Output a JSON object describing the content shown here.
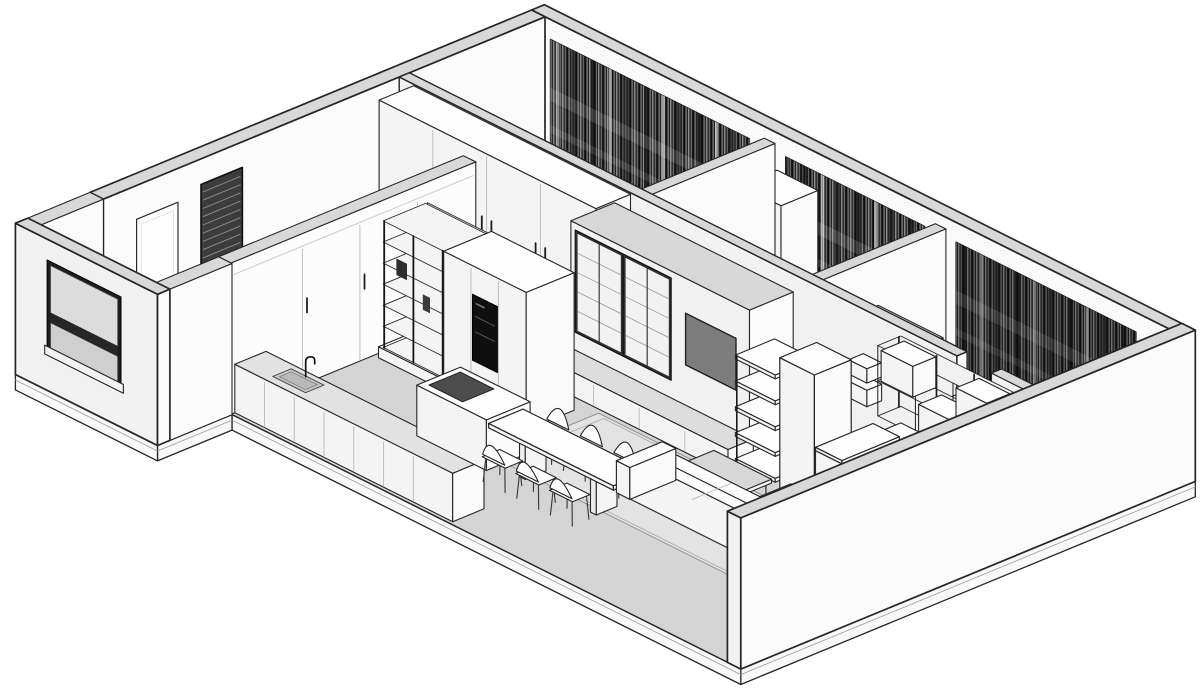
{
  "view": "axonometric-apartment-cutaway",
  "colors": {
    "background": "#ffffff",
    "outline": "#262626",
    "wall_top": "#d8d8d8",
    "wall_sw": "#f1f1f1",
    "wall_se": "#fbfbfb",
    "floor": "#d4d4d4",
    "floor_bedroom": "#ededed",
    "slab": "#f8f8f8",
    "rug": "#e3e3e3",
    "furn_top": "#fdfdfd",
    "furn_sw": "#f4f4f4",
    "furn_se": "#fafafa",
    "tv": "#7d7d7d",
    "cooktop": "#4d4d4d",
    "appliance": "#0f0f0f",
    "curtain": "#454545",
    "glass": "#dcdcdc",
    "metal": "#111111"
  },
  "projection": {
    "origin": [
      545,
      168
    ],
    "ux": [
      48,
      24
    ],
    "vy": [
      -46,
      19
    ],
    "zh": 55
  },
  "scene": {
    "elements": [
      {
        "t": "floor",
        "n": "floor-slab",
        "pts": [
          [
            -0.28,
            -0.28
          ],
          [
            13.28,
            -0.28
          ],
          [
            13.28,
            9.6
          ],
          [
            2.68,
            9.6
          ],
          [
            2.68,
            11.22
          ],
          [
            -0.28,
            11.22
          ]
        ],
        "edgeFrom": 1
      },
      {
        "t": "flat",
        "n": "bedroom-floor",
        "pts": [
          [
            0.1,
            0.1
          ],
          [
            12.9,
            0.1
          ],
          [
            12.9,
            2.95
          ],
          [
            0.1,
            2.95
          ]
        ],
        "fill": "#ededed"
      },
      {
        "t": "box",
        "n": "wall-ne",
        "x": -0.28,
        "y": -0.28,
        "dx": 13.56,
        "dy": 0.28,
        "dz": 2.75,
        "wall": true,
        "faces": [
          "top",
          "sw"
        ],
        "fsw": "#fafafa",
        "lw": 1.7
      },
      {
        "t": "box",
        "n": "wall-nw",
        "x": -0.28,
        "y": 0,
        "dx": 0.28,
        "dy": 9.6,
        "dz": 2.75,
        "wall": true,
        "faces": [
          "top",
          "se"
        ],
        "lw": 1.7
      },
      {
        "t": "blinds",
        "n": "entry-blinds-door",
        "x": 0.02,
        "y1": 6.6,
        "y2": 7.5,
        "z1": 0.06,
        "z2": 2.3
      },
      {
        "t": "doorX",
        "n": "hall-door",
        "x": 0.02,
        "y1": 8.0,
        "y2": 8.9,
        "z1": 0,
        "z2": 2.15
      },
      {
        "t": "curtain",
        "n": "curtains-bedroom-a",
        "x1": 0.4,
        "x2": 4.55,
        "dark": false
      },
      {
        "t": "curtain",
        "n": "curtains-bedroom-b",
        "x1": 5.3,
        "x2": 8.2,
        "dark": false
      },
      {
        "t": "curtain",
        "n": "curtains-bedroom-c",
        "x1": 8.85,
        "x2": 12.6,
        "dark": true
      },
      {
        "t": "box",
        "n": "bedroom-b-closet",
        "x": 5.12,
        "y": 0.3,
        "dx": 0.85,
        "dy": 0.8,
        "dz": 2.3,
        "seamsX": [
          5.55
        ]
      },
      {
        "t": "box",
        "n": "partition-a-b",
        "x": 4.84,
        "y": 0.28,
        "dx": 0.22,
        "dy": 2.67,
        "dz": 2.75,
        "wall": true
      },
      {
        "t": "box",
        "n": "partition-b-c",
        "x": 8.4,
        "y": 0.28,
        "dx": 0.22,
        "dy": 2.67,
        "dz": 2.75,
        "wall": true
      },
      {
        "t": "box",
        "n": "bedroom-c-closet",
        "x": 9.1,
        "y": 2.25,
        "dx": 1.35,
        "dy": 0.7,
        "dz": 2.25,
        "seamsX": [
          9.55,
          10.0
        ]
      },
      {
        "t": "box",
        "n": "wall-bedrooms-south-left",
        "x": 0,
        "y": 2.95,
        "dx": 11.62,
        "dy": 0.22,
        "dz": 2.75,
        "wall": true,
        "lw": 1.4
      },
      {
        "t": "box",
        "n": "wall-bedrooms-south-right",
        "x": 12.34,
        "y": 2.95,
        "dx": 0.66,
        "dy": 0.22,
        "dz": 2.75,
        "wall": true
      },
      {
        "t": "doorX",
        "n": "bedroom-c-door",
        "x": 11.66,
        "y1": 3.17,
        "y2": 3.95,
        "z1": 0,
        "z2": 2.08
      },
      {
        "t": "box",
        "n": "wall-cube-shelf-a",
        "x": 9.55,
        "y": 3.17,
        "z": 1.25,
        "dx": 0.5,
        "dy": 0.32,
        "dz": 0.3
      },
      {
        "t": "box",
        "n": "wall-cube-shelf-b",
        "x": 9.67,
        "y": 3.17,
        "z": 1.68,
        "dx": 0.38,
        "dy": 0.32,
        "dz": 0.26
      },
      {
        "t": "box",
        "n": "corridor-wardrobe",
        "x": 0.3,
        "y": 3.17,
        "dx": 4.52,
        "dy": 0.75,
        "dz": 2.72,
        "seamsX": [
          1.42,
          2.54,
          3.66
        ],
        "handles": true
      },
      {
        "t": "box",
        "n": "bathroom-block",
        "x": 4.9,
        "y": 3.6,
        "dx": 3.72,
        "dy": 0.95,
        "dz": 2.75,
        "wall": true
      },
      {
        "t": "glass",
        "n": "display-cabinet-left",
        "y": 4.56,
        "x1": 5.05,
        "x2": 5.95,
        "z1": 0.82,
        "z2": 2.58
      },
      {
        "t": "glass",
        "n": "display-cabinet-right",
        "y": 4.56,
        "x1": 6.05,
        "x2": 6.95,
        "z1": 0.82,
        "z2": 2.58
      },
      {
        "t": "tv",
        "n": "tv-screen",
        "y": 4.56,
        "x1": 7.3,
        "x2": 8.35,
        "z1": 1.18,
        "z2": 2.12
      },
      {
        "t": "box",
        "n": "media-console",
        "x": 4.95,
        "y": 4.55,
        "dx": 3.75,
        "dy": 0.55,
        "dz": 0.44,
        "ftop": "#dcdcdc",
        "seamsX": [
          5.9,
          6.85,
          7.8
        ]
      },
      {
        "t": "tower",
        "n": "tall-open-bookcase",
        "col": [
          9.78,
          4.3,
          0.72,
          0.8,
          2.58
        ],
        "shelf": [
          8.95,
          4.35,
          0.83,
          0.85
        ],
        "zs": [
          0.35,
          0.82,
          1.29,
          1.76,
          2.23
        ]
      },
      {
        "t": "grid",
        "n": "study-wall-shelf",
        "y": 3.17,
        "x1": 10.45,
        "x2": 12.8,
        "z1": 1.32,
        "z2": 2.6,
        "cols": 3,
        "boxes": [
          [
            10.52,
            1.98,
            0.66,
            0.56
          ],
          [
            11.3,
            1.34,
            0.64,
            0.56
          ],
          [
            12.08,
            1.98,
            0.64,
            0.56
          ]
        ]
      },
      {
        "t": "box",
        "n": "study-cabinet-a",
        "x": 10.45,
        "y": 3.17,
        "dx": 1.55,
        "dy": 0.6,
        "dz": 1.02,
        "seamsX": [
          11.2
        ]
      },
      {
        "t": "box",
        "n": "study-cabinet-b",
        "x": 12.05,
        "y": 3.17,
        "dx": 0.75,
        "dy": 0.6,
        "dz": 0.55
      },
      {
        "t": "box",
        "n": "study-cabinet-c",
        "x": 11.15,
        "y": 3.77,
        "dx": 0.85,
        "dy": 0.55,
        "dz": 0.5
      },
      {
        "t": "desk",
        "n": "desk",
        "x": 9.9,
        "w": 0.55,
        "y1": 3.2,
        "y2": 4.45,
        "topZ": 0.72
      },
      {
        "t": "box",
        "n": "hall-sliding-wardrobe",
        "x": 2.4,
        "y": 4.28,
        "dx": 0.26,
        "dy": 5.32,
        "dz": 2.75,
        "wall": true,
        "fse": "#fcfcfc",
        "seamsYse": [
          5.55,
          6.8,
          8.05
        ],
        "header": 2.52,
        "handlesY": [
          5.45,
          6.7,
          7.95
        ]
      },
      {
        "t": "bookshelf",
        "n": "black-frame-bookshelf",
        "x1": 2.82,
        "x2": 4.08,
        "yFront": 6.46,
        "depth": 0.96,
        "z0": 0.2,
        "h": 2.3,
        "plinth": [
          2.76,
          5.42,
          1.38,
          1.08,
          0.2
        ]
      },
      {
        "t": "box",
        "n": "kitchen-tall-cabinets",
        "x": 4.08,
        "y": 5.42,
        "dx": 1.72,
        "dy": 1.04,
        "dz": 2.5,
        "seamsX": [
          4.65,
          5.22
        ],
        "niche": [
          4.68,
          5.2,
          0.78,
          1.98
        ]
      },
      {
        "t": "box",
        "n": "kitchen-counter",
        "x": 2.66,
        "y": 8.84,
        "dx": 4.54,
        "dy": 0.68,
        "dz": 0.88,
        "ftop": "#e2e2e2",
        "seamsX": [
          3.28,
          3.9,
          4.52,
          5.14,
          5.76,
          6.38
        ]
      },
      {
        "t": "sink",
        "n": "kitchen-sink",
        "x1": 3.3,
        "y1": 8.96,
        "x2": 3.98,
        "y2": 9.36,
        "f": [
          3.62,
          8.98
        ]
      },
      {
        "t": "flat",
        "n": "living-rug",
        "pts": [
          [
            6.1,
            5.2
          ],
          [
            11.7,
            5.2
          ],
          [
            11.7,
            7.5
          ],
          [
            6.1,
            7.5
          ]
        ],
        "fill": "#e3e3e3",
        "stroke": "#8f8f8f",
        "inner": true
      },
      {
        "t": "box",
        "n": "kitchen-island",
        "x": 4.9,
        "y": 6.95,
        "dx": 1.45,
        "dy": 0.95,
        "dz": 0.92
      },
      {
        "t": "flat",
        "n": "cooktop",
        "pts": [
          [
            5.02,
            7.08
          ],
          [
            5.72,
            7.08
          ],
          [
            5.72,
            7.76
          ],
          [
            5.02,
            7.76
          ]
        ],
        "zl": 0.925,
        "fill": "#4d4d4d",
        "stroke": "#222222"
      },
      {
        "t": "chair",
        "n": "dining-chair-1",
        "cx": 6.6,
        "cy": 6.8,
        "face": "+y"
      },
      {
        "t": "chair",
        "n": "dining-chair-2",
        "cx": 7.3,
        "cy": 6.8,
        "face": "+y"
      },
      {
        "t": "chair",
        "n": "dining-chair-3",
        "cx": 8.0,
        "cy": 6.8,
        "face": "+y"
      },
      {
        "t": "table",
        "n": "dining-table",
        "x": 6.3,
        "y": 7.05,
        "dx": 2.6,
        "dy": 0.75,
        "topZ": 0.72
      },
      {
        "t": "chair",
        "n": "dining-chair-4",
        "cx": 6.8,
        "cy": 8.02,
        "face": "-y"
      },
      {
        "t": "chair",
        "n": "dining-chair-5",
        "cx": 7.5,
        "cy": 8.02,
        "face": "-y"
      },
      {
        "t": "chair",
        "n": "dining-chair-6",
        "cx": 8.2,
        "cy": 8.02,
        "face": "-y"
      },
      {
        "t": "ctable",
        "n": "coffee-table",
        "x": 8.55,
        "y": 5.25,
        "dx": 1.2,
        "dy": 0.6,
        "topZ": 0.34
      },
      {
        "t": "sofa",
        "n": "sofa",
        "chaise": [
          10.15,
          5.25,
          0.12,
          0.75,
          0.72,
          0.38
        ],
        "seat": [
          8.35,
          5.95,
          0.12,
          2.55,
          0.9,
          0.4
        ],
        "back": [
          8.35,
          6.6,
          0,
          2.55,
          0.27,
          0.78
        ],
        "armL": [
          8.08,
          5.88,
          0,
          0.28,
          1.0,
          0.58
        ],
        "armR": [
          10.9,
          5.88,
          0,
          0.28,
          1.0,
          0.58
        ],
        "seam": 9.6
      },
      {
        "t": "barrel",
        "n": "armchair-living",
        "cx": 11.35,
        "cy": 5.38
      },
      {
        "t": "barrel",
        "n": "armchair-study-1",
        "cx": 12.1,
        "cy": 5.72
      },
      {
        "t": "sideTable",
        "n": "round-side-table",
        "cx": 11.62,
        "cy": 6.35
      },
      {
        "t": "barrel",
        "n": "armchair-study-2",
        "cx": 12.35,
        "cy": 6.6
      },
      {
        "t": "box",
        "n": "wall-se",
        "x": 13,
        "y": -0.28,
        "dx": 0.28,
        "dy": 9.88,
        "dz": 2.75,
        "wall": true,
        "faces": [
          "top",
          "se",
          "sw"
        ],
        "lw": 1.7
      },
      {
        "t": "box",
        "n": "entry-wall-nw",
        "x": -0.28,
        "y": 9.6,
        "dx": 0.28,
        "dy": 1.62,
        "dz": 2.75,
        "wall": true,
        "faces": [
          "top",
          "se"
        ]
      },
      {
        "t": "box",
        "n": "entry-threshold",
        "x": 0.35,
        "y": 9.4,
        "dx": 0.7,
        "dy": 0.2,
        "dz": 0.1
      },
      {
        "t": "box",
        "n": "entry-wall-se",
        "x": 2.4,
        "y": 9.6,
        "dx": 0.28,
        "dy": 1.62,
        "dz": 2.75,
        "wall": true,
        "faces": [
          "top",
          "se",
          "sw"
        ]
      },
      {
        "t": "box",
        "n": "entry-wall-sw",
        "x": -0.28,
        "y": 10.95,
        "dx": 2.96,
        "dy": 0.27,
        "dz": 2.75,
        "wall": true,
        "faces": [
          "top",
          "sw",
          "se"
        ],
        "lw": 1.7
      },
      {
        "t": "window",
        "n": "entry-window",
        "y": 11.22,
        "x1": 0.45,
        "x2": 1.85,
        "z1": 0.8,
        "z2": 2.3
      }
    ]
  }
}
